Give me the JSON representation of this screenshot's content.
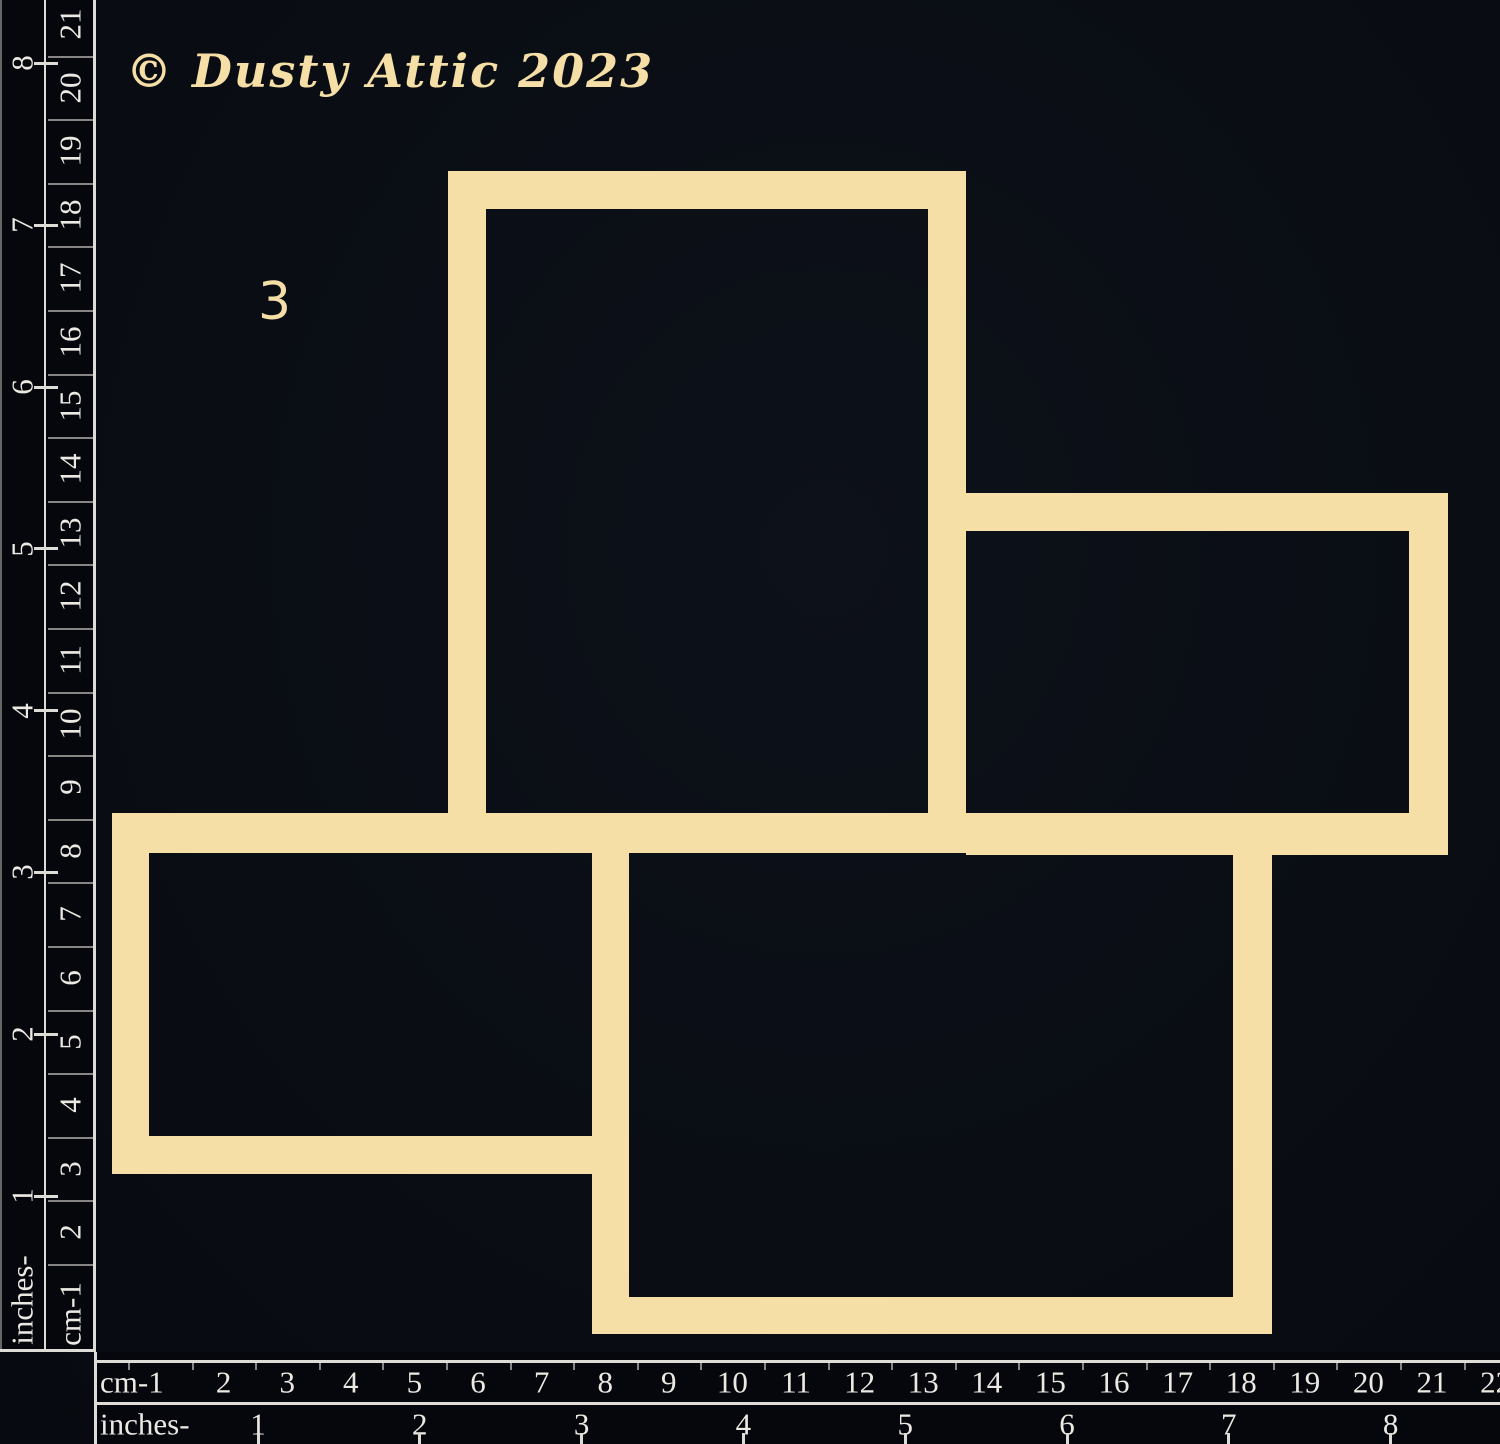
{
  "branding": {
    "copyright": "© Dusty Attic 2023"
  },
  "piece": {
    "number": "3"
  },
  "rulers": {
    "left": {
      "cm_label": "cm-1",
      "inch_label": "inches-",
      "cm_numbers": [
        2,
        3,
        4,
        5,
        6,
        7,
        8,
        9,
        10,
        11,
        12,
        13,
        14,
        15,
        16,
        17,
        18,
        19,
        20,
        21
      ],
      "inch_numbers": [
        1,
        2,
        3,
        4,
        5,
        6,
        7,
        8
      ]
    },
    "bottom": {
      "cm_label": "cm-1",
      "inch_label": "inches-",
      "cm_numbers": [
        2,
        3,
        4,
        5,
        6,
        7,
        8,
        9,
        10,
        11,
        12,
        13,
        14,
        15,
        16,
        17,
        18,
        19,
        20,
        21,
        22
      ],
      "inch_numbers": [
        1,
        2,
        3,
        4,
        5,
        6,
        7,
        8
      ]
    }
  },
  "colors": {
    "background": "#0a0d14",
    "chipboard": "#f5dfa6",
    "ruler_black": "#05070c",
    "ruler_lines": "#dedcd7",
    "ruler_text": "#ece9e3"
  }
}
